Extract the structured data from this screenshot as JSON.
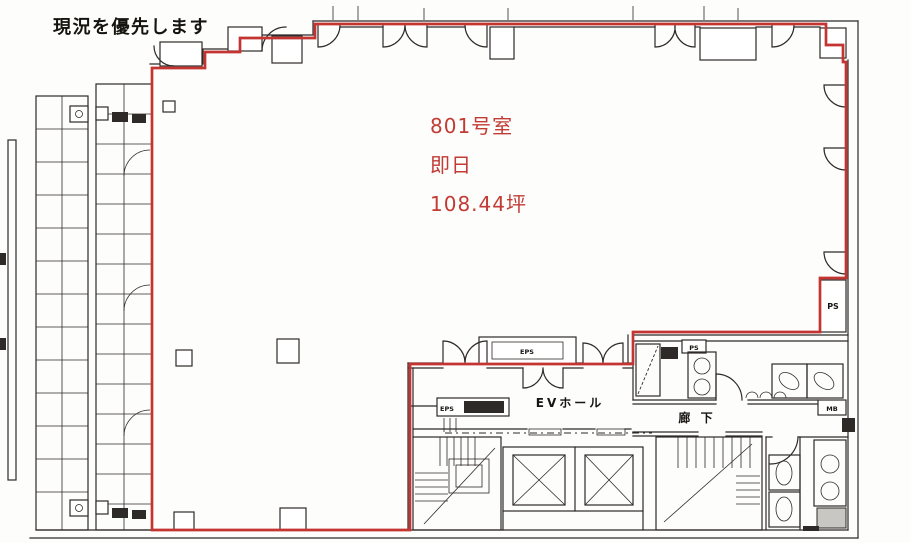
{
  "document": {
    "type_note": "現況を優先します"
  },
  "unit": {
    "room_number": "801号室",
    "availability": "即日",
    "area": "108.44坪"
  },
  "core": {
    "ev_hall": "EVホール",
    "corridor": "廊 下",
    "eps_box": "EPS",
    "eps_panel": "EPS",
    "ps_right": "PS",
    "ps_small": "PS",
    "mb": "MB"
  },
  "colors": {
    "boundary_red": "#c43532",
    "ink": "#2e2a28",
    "paper": "#fdfdfc",
    "highlight_text": "#c23b34"
  }
}
